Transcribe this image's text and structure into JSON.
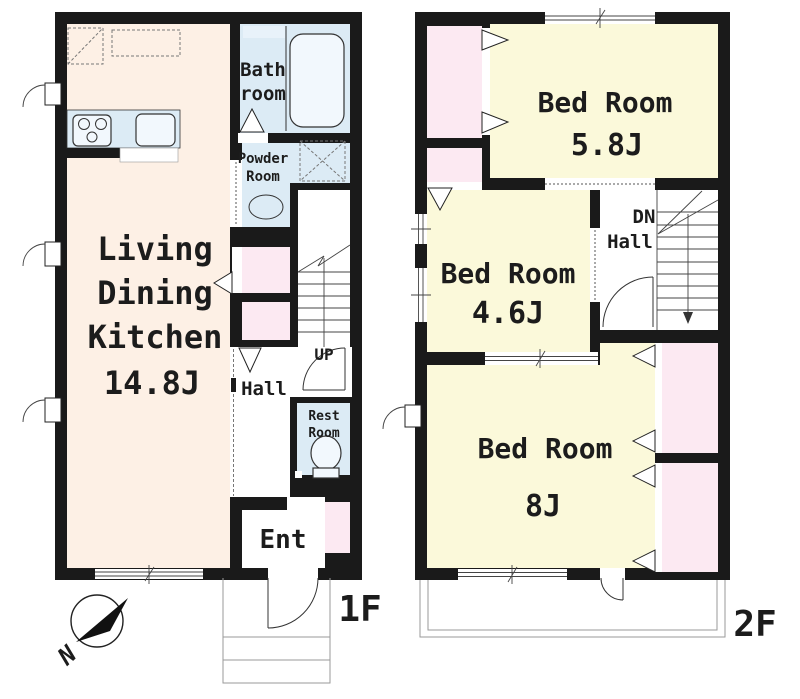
{
  "title": "Two-story house floor plan",
  "colors": {
    "wall": "#1a1a1a",
    "ldk_fill": "#fdf0e5",
    "bedroom_fill": "#fbf9da",
    "closet_fill": "#fce9f2",
    "wet_area_fill": "#dcebf5",
    "fixture_fill": "#f2f8fd",
    "outline": "#333333"
  },
  "floor1": {
    "floor_label": "1F",
    "ldk": {
      "line1": "Living",
      "line2": "Dining",
      "line3": "Kitchen",
      "size": "14.8J"
    },
    "bath": {
      "line1": "Bath",
      "line2": "room"
    },
    "powder": {
      "line1": "Powder",
      "line2": "Room"
    },
    "hall": "Hall",
    "stairs_up": "UP",
    "restroom": {
      "line1": "Rest",
      "line2": "Room"
    },
    "entrance": "Ent",
    "compass_north": "N"
  },
  "floor2": {
    "floor_label": "2F",
    "bedroom_5_8": {
      "name": "Bed Room",
      "size": "5.8J"
    },
    "bedroom_4_6": {
      "name": "Bed Room",
      "size": "4.6J"
    },
    "bedroom_8": {
      "name": "Bed Room",
      "size": "8J"
    },
    "stairs_down": "DN",
    "hall": "Hall"
  }
}
